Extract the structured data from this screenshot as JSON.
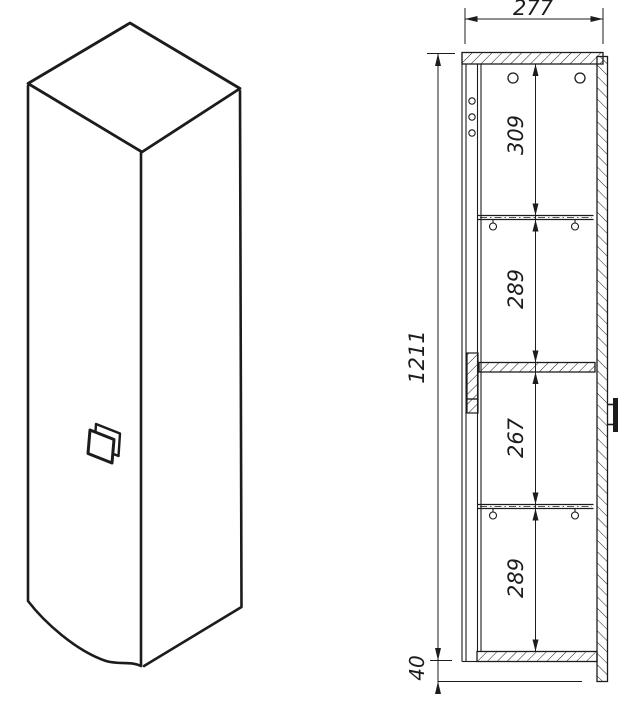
{
  "labels": {
    "width": "277",
    "height": "1211",
    "shelf1": "309",
    "shelf2": "289",
    "shelf3": "267",
    "shelf4": "289",
    "bottom_gap": "40"
  },
  "colors": {
    "line": "#1c1c1c",
    "background": "#ffffff"
  }
}
